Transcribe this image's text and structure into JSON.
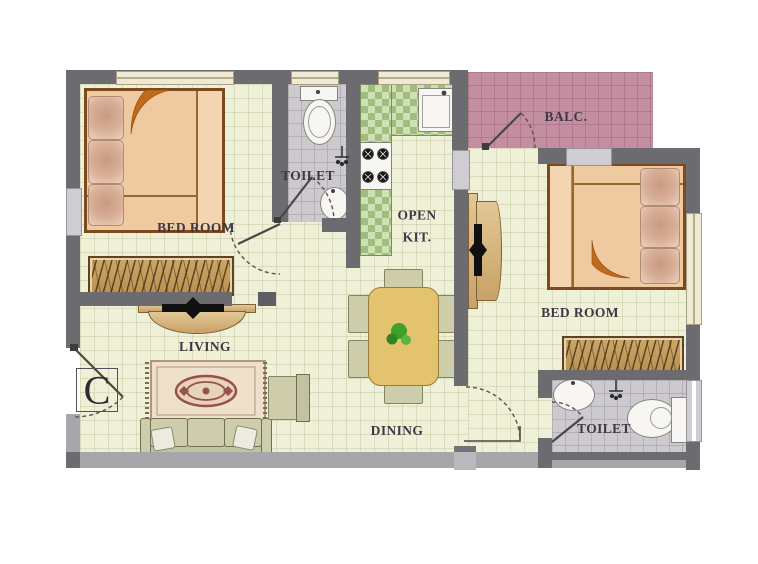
{
  "unit": {
    "label": "C"
  },
  "rooms": {
    "bedroom_left": {
      "label": "BED ROOM"
    },
    "toilet_top": {
      "label": "TOILET"
    },
    "kitchen": {
      "line1": "OPEN",
      "line2": "KIT."
    },
    "balcony": {
      "label": "BALC."
    },
    "bedroom_right": {
      "label": "BED ROOM"
    },
    "living": {
      "label": "LIVING"
    },
    "dining": {
      "label": "DINING"
    },
    "toilet_bottom": {
      "label": "TOILET"
    }
  },
  "colors": {
    "wall": "#6c6b70",
    "wall_light": "#a7a6ab",
    "floor": "#eff0d8",
    "balcony_floor": "#c38fa0",
    "toilet_floor": "#cdcacf",
    "window": "#f0ead2",
    "bed": "#efc9a0",
    "bed_frame": "#7b4a1e",
    "blanket_fold": "#c06a1c",
    "wardrobe": "#c89f63",
    "kitchen_counter": "#b9cf9b",
    "dining_table": "#e4c36f",
    "seating": "#cdcdac",
    "rug": "#eee0cb",
    "rug_accent": "#98504a",
    "plant": "#3fa12c",
    "label_text": "#3f3744"
  }
}
